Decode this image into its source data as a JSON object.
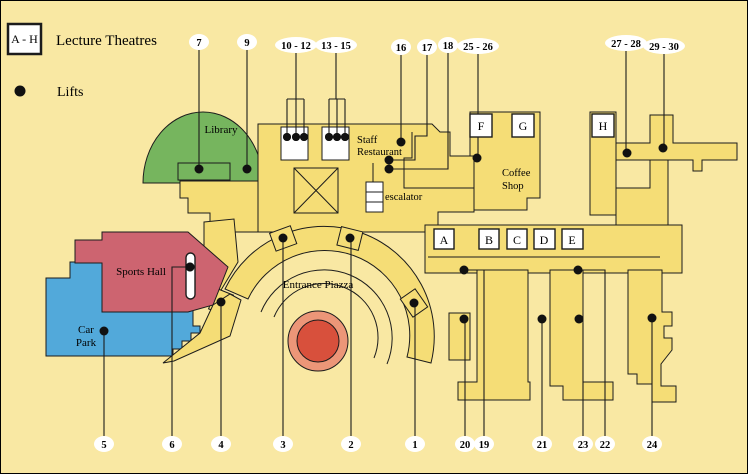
{
  "legend": {
    "range_label": "A - H",
    "lecture_theatres": "Lecture Theatres",
    "lifts": "Lifts"
  },
  "areas": {
    "library": "Library",
    "staff_restaurant_line1": "Staff",
    "staff_restaurant_line2": "Restaurant",
    "escalator": "escalator",
    "coffee_shop_line1": "Coffee",
    "coffee_shop_line2": "Shop",
    "sports_hall": "Sports Hall",
    "car_park_line1": "Car",
    "car_park_line2": "Park",
    "entrance_piazza": "Entrance Piazza"
  },
  "lecture_theatres": [
    {
      "label": "A"
    },
    {
      "label": "B"
    },
    {
      "label": "C"
    },
    {
      "label": "D"
    },
    {
      "label": "E"
    },
    {
      "label": "F"
    },
    {
      "label": "G"
    },
    {
      "label": "H"
    }
  ],
  "lifts": [
    {
      "label": "7"
    },
    {
      "label": "9"
    },
    {
      "label": "10 - 12"
    },
    {
      "label": "13 - 15"
    },
    {
      "label": "16"
    },
    {
      "label": "17"
    },
    {
      "label": "18"
    },
    {
      "label": "25 - 26"
    },
    {
      "label": "27 - 28"
    },
    {
      "label": "29 - 30"
    },
    {
      "label": "5"
    },
    {
      "label": "6"
    },
    {
      "label": "4"
    },
    {
      "label": "3"
    },
    {
      "label": "2"
    },
    {
      "label": "1"
    },
    {
      "label": "20"
    },
    {
      "label": "19"
    },
    {
      "label": "21"
    },
    {
      "label": "23"
    },
    {
      "label": "22"
    },
    {
      "label": "24"
    }
  ],
  "colors": {
    "background": "#f9e8a3",
    "building": "#f5dd76",
    "library_green": "#76b55e",
    "sports_hall_red": "#cd6470",
    "car_park_blue": "#52a9da",
    "piazza_ring_outer": "#ec9678",
    "piazza_ring_inner": "#d8503c",
    "outline": "#1c1c1c",
    "callout_bubble": "#ffffff"
  }
}
